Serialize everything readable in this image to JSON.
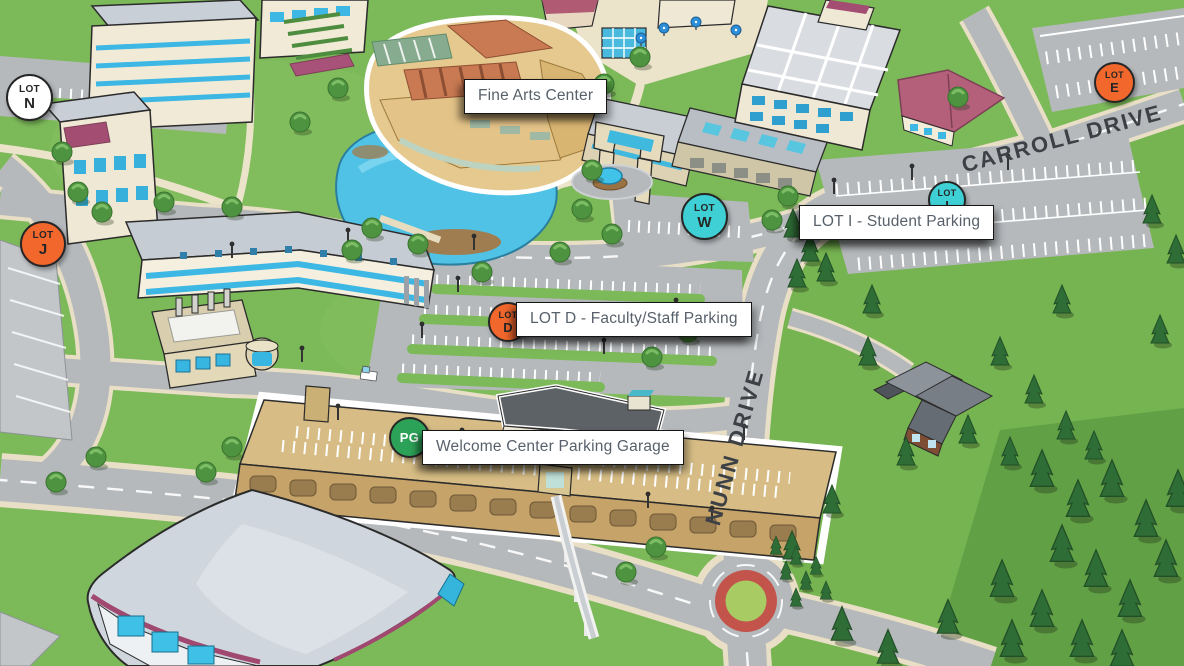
{
  "map": {
    "type": "illustrated-campus-map"
  },
  "labels": {
    "fine_arts": "Fine Arts Center",
    "lot_i": "LOT I - Student Parking",
    "lot_d": "LOT D - Faculty/Staff Parking",
    "welcome_garage": "Welcome Center Parking Garage"
  },
  "roads": {
    "nunn": "NUNN DRIVE",
    "carroll": "CARROLL DRIVE"
  },
  "markers": {
    "lot_n": {
      "line1": "LOT",
      "line2": "N",
      "color": "#ffffff"
    },
    "lot_j": {
      "line1": "LOT",
      "line2": "J",
      "color": "#f2672c"
    },
    "lot_e": {
      "line1": "LOT",
      "line2": "E",
      "color": "#f2672c"
    },
    "lot_w": {
      "line1": "LOT",
      "line2": "W",
      "color": "#3ed0d4"
    },
    "lot_i": {
      "line1": "LOT",
      "line2": "I",
      "color": "#3ed0d4"
    },
    "lot_d": {
      "line1": "LOT",
      "line2": "D",
      "color": "#f2672c"
    },
    "pg": {
      "label": "PG",
      "color": "#2ca258"
    }
  },
  "palette": {
    "grass": "#7cb959",
    "road": "#b5b9bc",
    "water": "#4fc2e6",
    "label_text": "#58616b",
    "road_text": "#3d4145",
    "highlight_outline": "#ffffff"
  }
}
